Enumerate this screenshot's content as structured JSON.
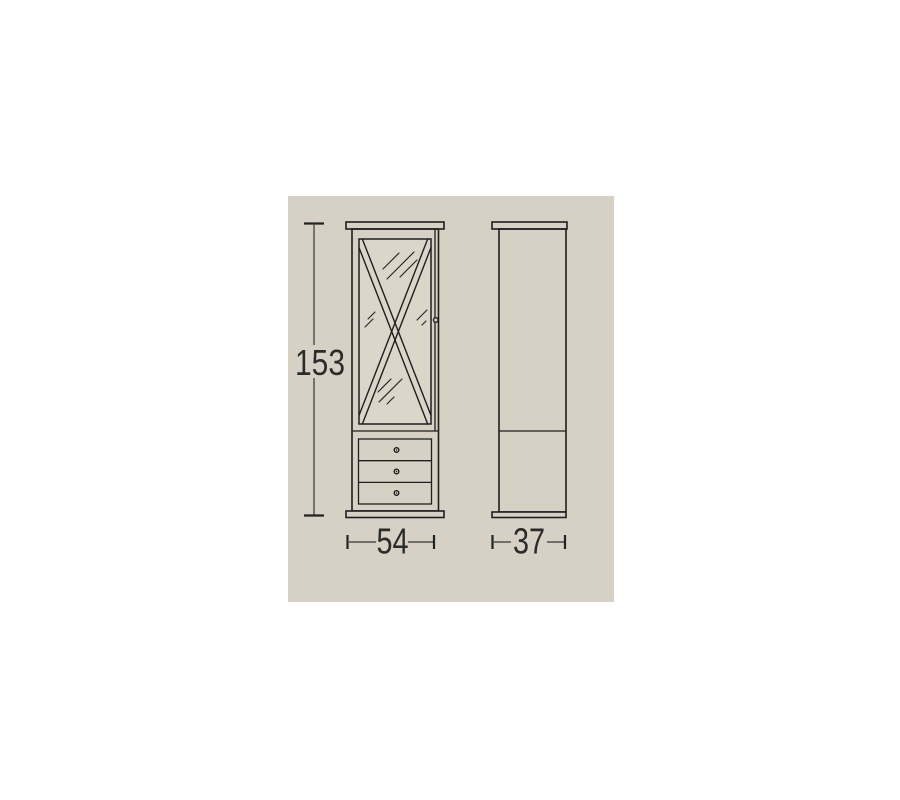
{
  "page": {
    "background": "#ffffff"
  },
  "canvas": {
    "background": "#d7d1c5"
  },
  "drawing": {
    "kind": "furniture-dimension-diagram",
    "subject": "display cabinet with X-lattice glass door and three drawers, front and side elevations",
    "colors": {
      "canvas_background": "#d7d1c5",
      "line": "#1f1f1f",
      "dimension_line": "#4d4d4d",
      "text": "#2b2b2b"
    },
    "dimensions": {
      "height": {
        "value": "153",
        "orientation": "vertical"
      },
      "width": {
        "value": "54",
        "orientation": "horizontal"
      },
      "depth": {
        "value": "37",
        "orientation": "horizontal"
      }
    }
  }
}
